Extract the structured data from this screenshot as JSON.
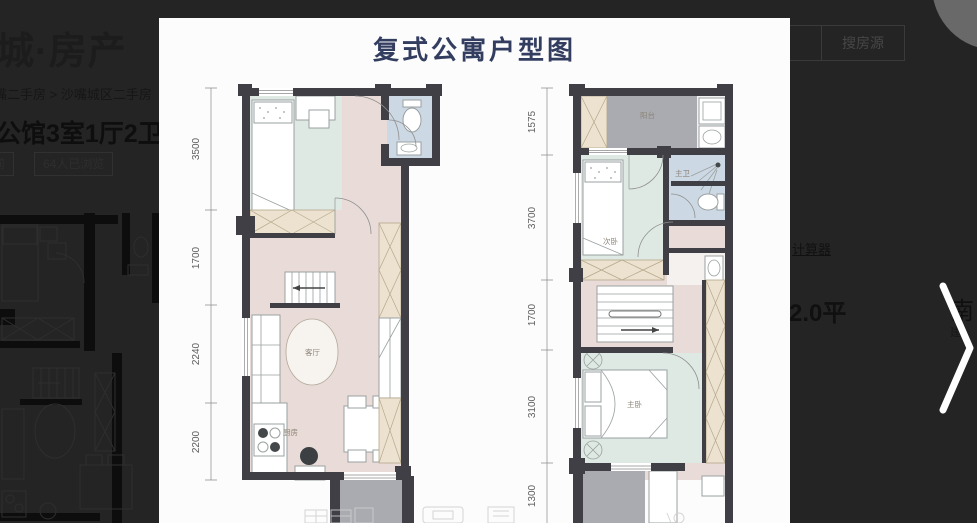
{
  "page": {
    "background": "#242424"
  },
  "header": {
    "logo": "城·房产",
    "search_button_label": "搜房源"
  },
  "breadcrumb": {
    "text": "嘴二手房 > 沙嘴城区二手房"
  },
  "listing": {
    "title": "公馆3室1厅2卫",
    "time_tag": "时前",
    "views_tag": "64人已浏览",
    "calculator_link": "计算器",
    "area_text": "2.0平",
    "orientation_text": "南",
    "build_year_partial": "建"
  },
  "lightbox": {
    "title": "复式公寓户型图",
    "title_color": "#323d60"
  },
  "floorplan": {
    "colors": {
      "wall": "#3f3f45",
      "floor_pink": "#e9dcd8",
      "bedroom_mint": "#dfe9e3",
      "bath_blue": "#ccd8e3",
      "closet_beige": "#ece2cf",
      "balcony_gray": "#a9abb1"
    },
    "left_unit": {
      "dims": [
        "3500",
        "1700",
        "2240",
        "2200"
      ],
      "labels": {
        "living": "客厅",
        "kitchen": "厨房"
      }
    },
    "right_unit": {
      "dims": [
        "1575",
        "3700",
        "1700",
        "3100",
        "1300"
      ],
      "labels": {
        "balcony": "阳台",
        "second_bedroom": "次卧",
        "master_bath": "主卫",
        "master_bedroom": "主卧"
      }
    }
  }
}
